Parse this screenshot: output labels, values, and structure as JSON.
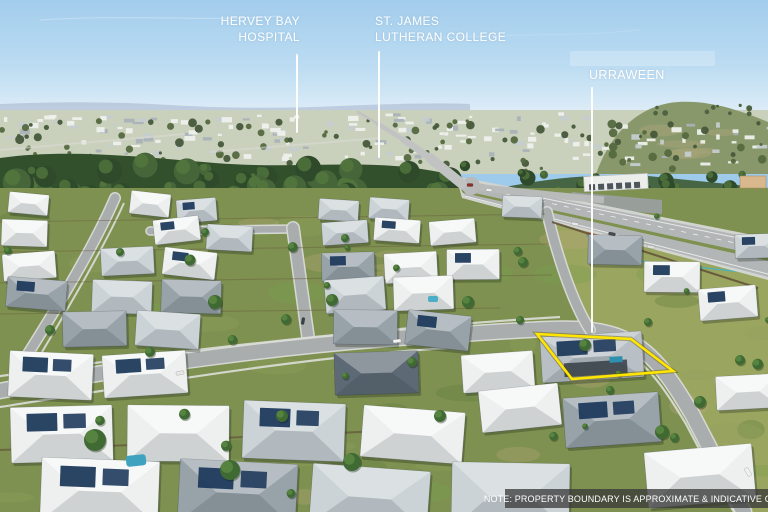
{
  "scene": {
    "type": "aerial-drone-photograph",
    "description": "Aerial view of a suburban housing estate with annotated landmarks and a highlighted property boundary"
  },
  "annotations": {
    "labels": [
      {
        "id": "hervey-bay-hospital",
        "lines": [
          "HERVEY BAY",
          "HOSPITAL"
        ],
        "align": "right"
      },
      {
        "id": "st-james-lutheran-college",
        "lines": [
          "ST. JAMES",
          "LUTHERAN COLLEGE"
        ],
        "align": "left"
      },
      {
        "id": "urraween",
        "lines": [
          "URRAWEEN"
        ],
        "align": "left"
      }
    ],
    "pointer_lines": [
      {
        "x": 297,
        "y1": 55,
        "y2": 132
      },
      {
        "x": 379,
        "y1": 52,
        "y2": 157
      },
      {
        "x": 592,
        "y1": 88,
        "y2": 332
      }
    ],
    "boundary": {
      "points": "537,334 631,339 673,371 572,379"
    },
    "note": {
      "text": "NOTE: PROPERTY BOUNDARY IS APPROXIMATE & INDICATIVE ONLY"
    }
  },
  "palette": {
    "sky_top": "#a2cdec",
    "sky_bottom": "#e3eff8",
    "boundary": "#ffe600",
    "label": "#ffffff",
    "note_bg": "rgba(55,55,55,0.75)",
    "roof_white": "#eef0ef",
    "roof_light": "#ccd3d7",
    "roof_mid": "#97a2a9",
    "roof_dark": "#5d6974",
    "solar": "#1f3a5c",
    "street": "#a9adad",
    "road": "#b2b6b7",
    "grass": "#7e9150",
    "grass_olive": "#9aa55f",
    "tree_dark": "#33502c",
    "tree_light": "#5d8a42",
    "dirt": "#ad7a4f",
    "fence_teal": "#45b4c2",
    "fence_brown": "#5d4a33"
  }
}
